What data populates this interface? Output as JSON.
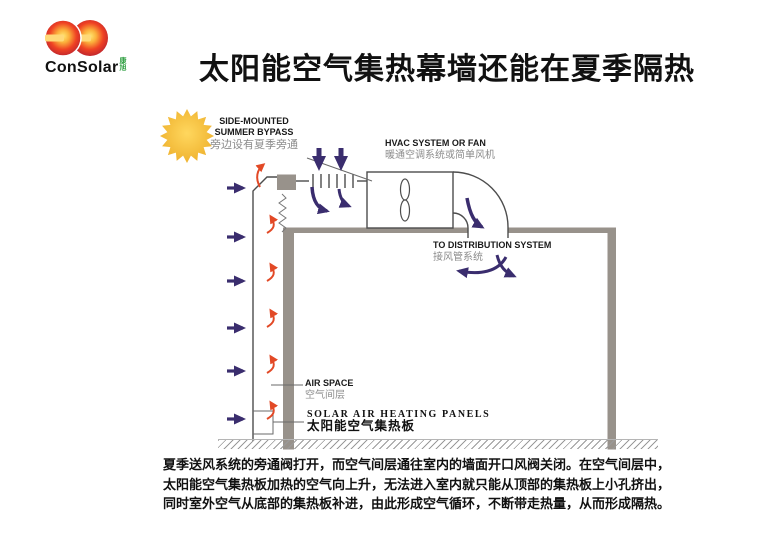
{
  "logo": {
    "brand": "ConSolar",
    "sub": "康旭"
  },
  "title": "太阳能空气集热幕墙还能在夏季隔热",
  "diagram": {
    "labels": {
      "bypass_en1": "SIDE-MOUNTED",
      "bypass_en2": "SUMMER BYPASS",
      "bypass_cn": "旁边设有夏季旁通",
      "hvac_en": "HVAC SYSTEM OR FAN",
      "hvac_cn": "暖通空调系统或简单风机",
      "dist_en": "TO DISTRIBUTION SYSTEM",
      "dist_cn": "接风管系统",
      "airspace_en": "AIR SPACE",
      "airspace_cn": "空气间层",
      "panels_en": "SOLAR AIR HEATING PANELS",
      "panels_cn": "太阳能空气集热板"
    },
    "icons": {
      "sun": "sun-icon",
      "fan": "fan-icon"
    },
    "colors": {
      "flow_arrow_purple": "#3a2d6e",
      "hot_air_red": "#e24926",
      "structure_grey": "#98928b",
      "sun_gold": "#f3c238",
      "logo_red": "#d93018",
      "logo_orange": "#f7941d",
      "logo_sub_green": "#2e9e40",
      "label_grey": "#8c8c8c"
    }
  },
  "caption": {
    "lines": [
      "夏季送风系统的旁通阀打开，而空气间层通往室内的墙面开口风阀关闭。在空气间层中，",
      "太阳能空气集热板加热的空气向上升，无法进入室内就只能从顶部的集热板上小孔挤出，",
      "同时室外空气从底部的集热板补进，由此形成空气循环，不断带走热量，从而形成隔热。"
    ]
  }
}
